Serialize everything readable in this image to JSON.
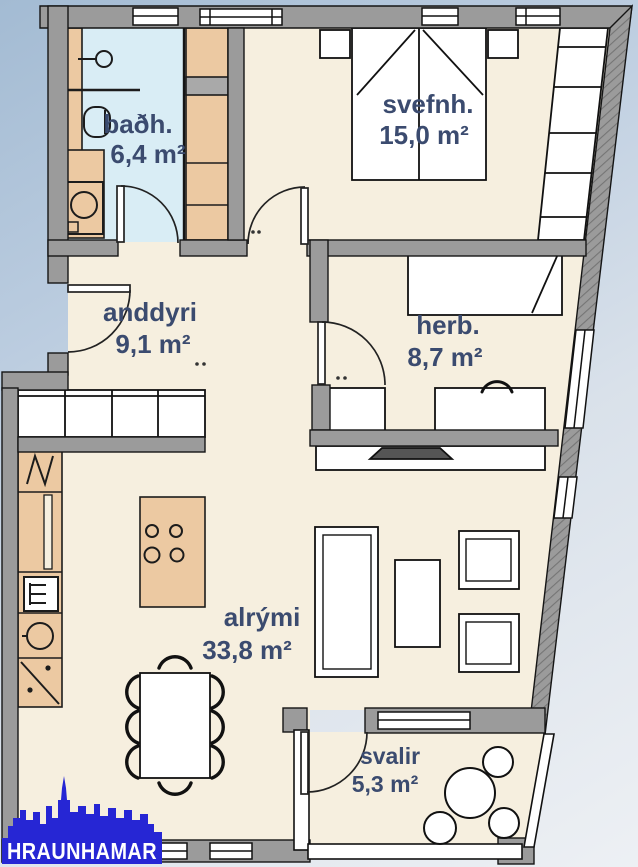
{
  "floorplan": {
    "type": "apartment-floor-plan",
    "rooms": [
      {
        "id": "bathroom",
        "label": "baðh.",
        "area": "6,4 m²"
      },
      {
        "id": "bedroom",
        "label": "svefnh.",
        "area": "15,0 m²"
      },
      {
        "id": "entry-hall",
        "label": "anddyri",
        "area": "9,1 m²"
      },
      {
        "id": "bedroom2",
        "label": "herb.",
        "area": "8,7 m²"
      },
      {
        "id": "living-area",
        "label": "alrými",
        "area": "33,8 m²"
      },
      {
        "id": "balcony",
        "label": "svalir",
        "area": "5,3 m²"
      }
    ],
    "colors": {
      "label_text": "#3b4b6f",
      "floor": "#f6efdf",
      "bathroom_floor": "#d9edf5",
      "wood_furniture": "#ecc9a2",
      "wall_gray": "#9b9b9b",
      "background_top": "#a3bbd3",
      "background_bottom": "#edf0f4"
    }
  },
  "branding": {
    "agency": "HRAUNHAMAR",
    "logo_blue": "#2626d4",
    "logo_text_color": "#ffffff"
  }
}
